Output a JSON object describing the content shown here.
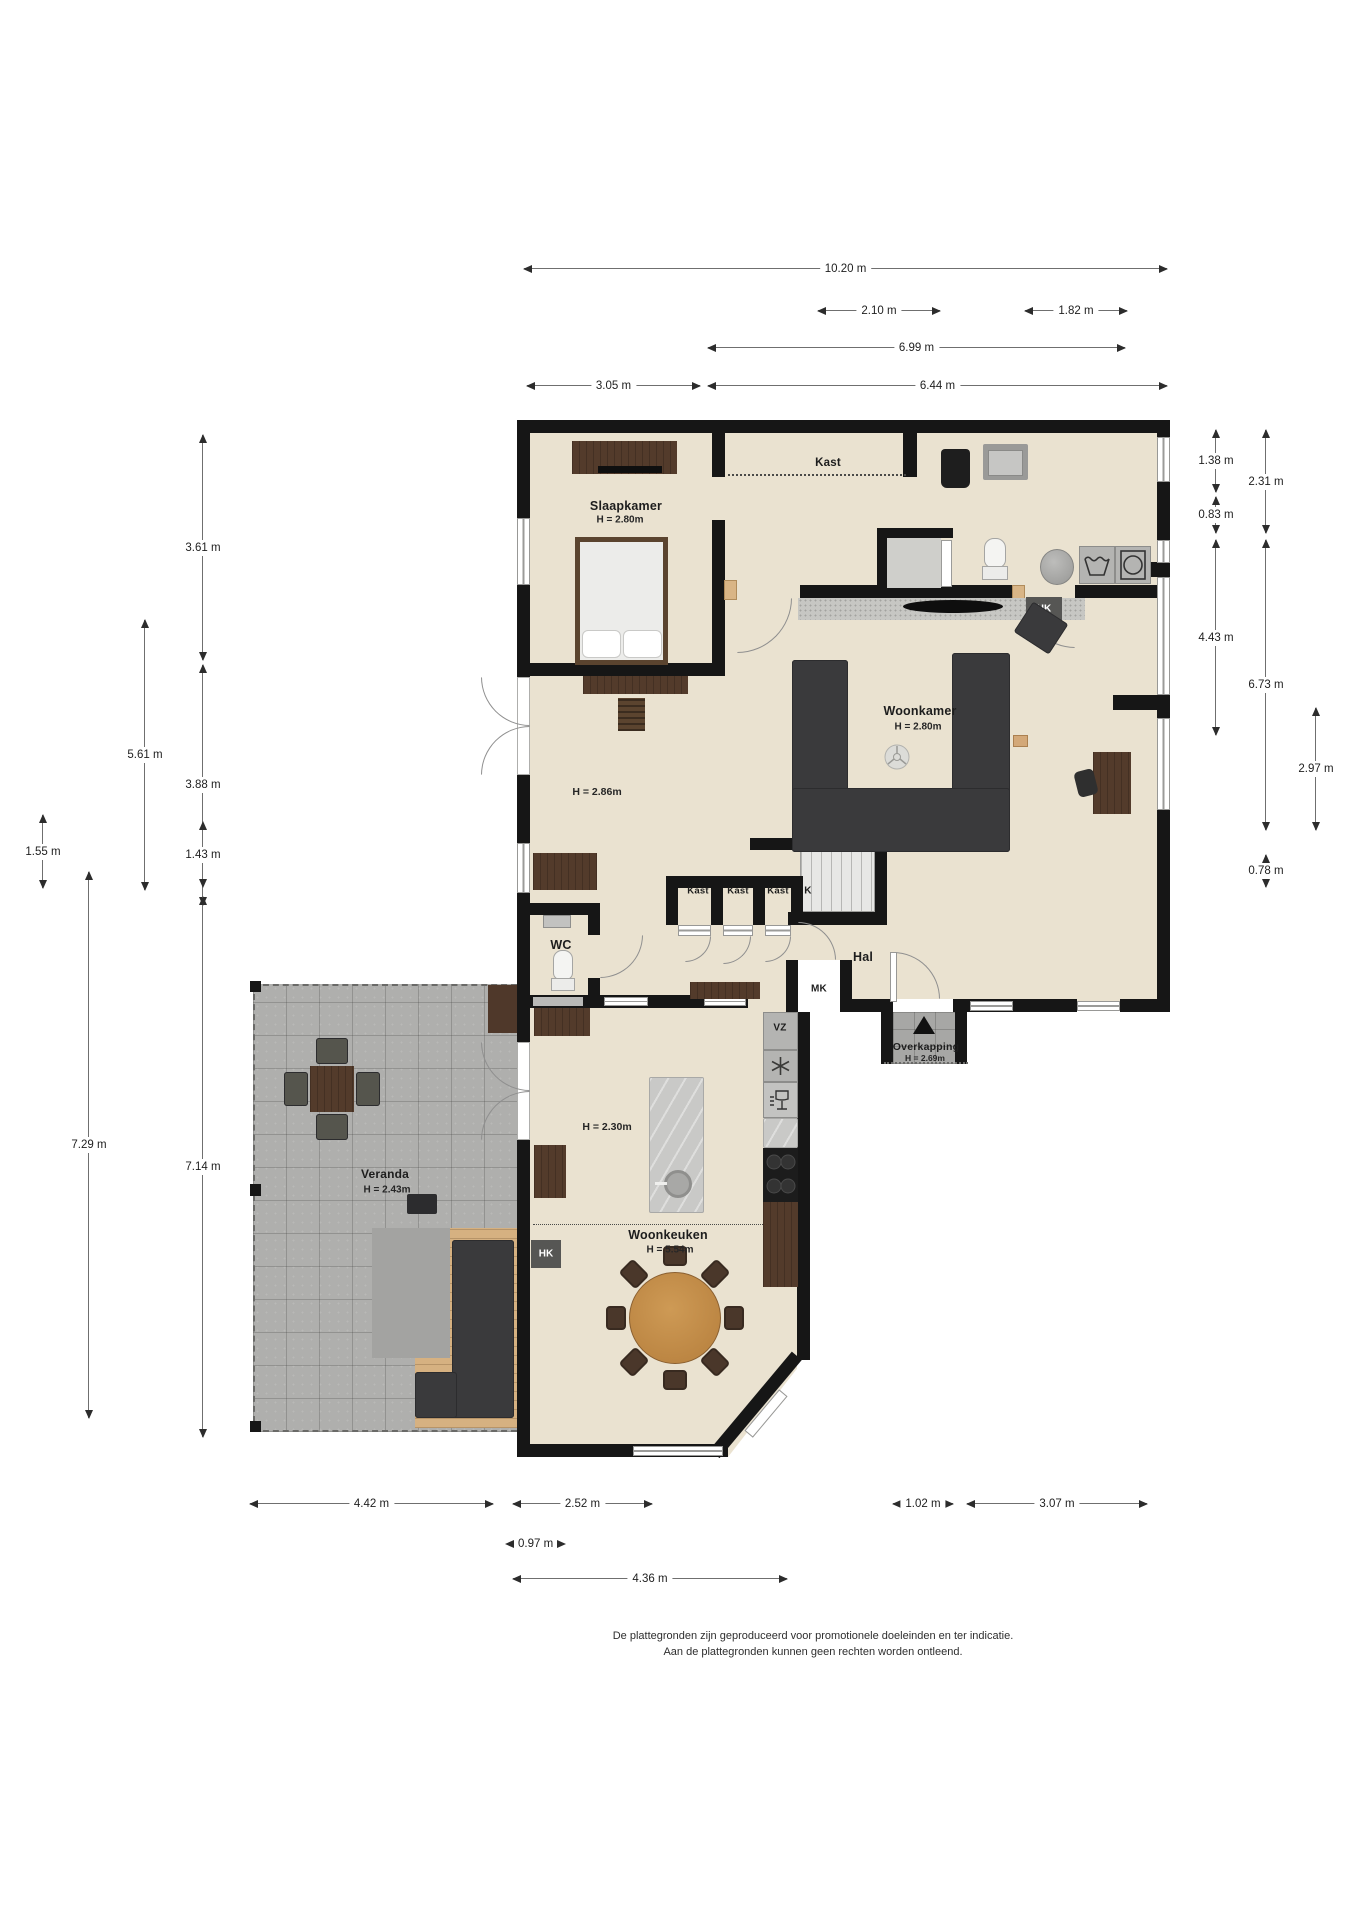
{
  "rooms": {
    "slaapkamer": {
      "name": "Slaapkamer",
      "height": "H = 2.80m"
    },
    "kast": {
      "name": "Kast"
    },
    "woonkamer": {
      "name": "Woonkamer",
      "height": "H = 2.80m"
    },
    "hal_zone": {
      "height": "H = 2.86m"
    },
    "wc": {
      "name": "WC"
    },
    "hal": {
      "name": "Hal"
    },
    "closet1": {
      "name": "Kast"
    },
    "closet2": {
      "name": "Kast"
    },
    "closet3": {
      "name": "Kast"
    },
    "closet4": {
      "name": "K"
    },
    "mk": {
      "name": "MK"
    },
    "vz": {
      "name": "VZ"
    },
    "hk_badkamer": {
      "name": "HK"
    },
    "hk_keuken": {
      "name": "HK"
    },
    "overkapping": {
      "name": "Overkapping",
      "height": "H = 2.69m"
    },
    "veranda": {
      "name": "Veranda",
      "height": "H = 2.43m"
    },
    "woonkeuken": {
      "name": "Woonkeuken",
      "height": "H = 5.54m"
    },
    "keuken_zone": {
      "height": "H = 2.30m"
    }
  },
  "dimensions": {
    "top": [
      {
        "label": "10.20 m"
      },
      {
        "label": "2.10 m"
      },
      {
        "label": "1.82 m"
      },
      {
        "label": "6.99 m"
      },
      {
        "label": "3.05 m"
      },
      {
        "label": "6.44 m"
      }
    ],
    "left": [
      {
        "label": "3.61 m"
      },
      {
        "label": "3.88 m"
      },
      {
        "label": "5.61 m"
      },
      {
        "label": "1.55 m"
      },
      {
        "label": "1.43 m"
      },
      {
        "label": "7.29 m"
      },
      {
        "label": "7.14 m"
      }
    ],
    "right": [
      {
        "label": "1.38 m"
      },
      {
        "label": "2.31 m"
      },
      {
        "label": "0.83 m"
      },
      {
        "label": "4.43 m"
      },
      {
        "label": "6.73 m"
      },
      {
        "label": "2.97 m"
      },
      {
        "label": "0.78 m"
      }
    ],
    "bottom": [
      {
        "label": "4.42 m"
      },
      {
        "label": "2.52 m"
      },
      {
        "label": "1.02 m"
      },
      {
        "label": "3.07 m"
      },
      {
        "label": "0.97 m"
      },
      {
        "label": "4.36 m"
      }
    ]
  },
  "footer": {
    "line1": "De plattegronden zijn geproduceerd voor promotionele doeleinden en ter indicatie.",
    "line2": "Aan de plattegronden kunnen geen rechten worden ontleend."
  },
  "colors": {
    "floor": "#EAE2D0",
    "wall": "#161616",
    "veranda_tile": "#AFAFAD",
    "wood_dark": "#533B2B",
    "dining_table": "#C28B47",
    "sofa": "#3A3A3C",
    "counter_speckle": "#C7C7C3",
    "deck": "#D6B181"
  }
}
